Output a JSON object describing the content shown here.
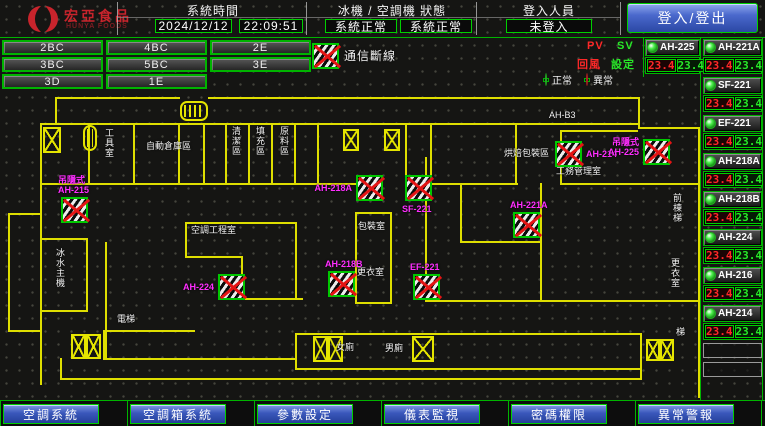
{
  "colors": {
    "accent_green": "#00c800",
    "alarm_red": "#e41414",
    "magenta": "#ff2eff",
    "wall_yellow": "#dede00",
    "button_blue": "#3a57bb"
  },
  "header": {
    "logo": {
      "brand": "宏亞食品",
      "brand_sub": "HUNYA FOODS"
    },
    "system_time": {
      "label": "系統時間",
      "date": "2024/12/12",
      "time": "22:09:51"
    },
    "machine_status": {
      "label": "冰機 / 空調機 狀態",
      "chiller": "系統正常",
      "ahu": "系統正常"
    },
    "login": {
      "label": "登入人員",
      "user": "未登入",
      "button_label": "登入/登出"
    }
  },
  "floor_nav": {
    "buttons": [
      "2BC",
      "4BC",
      "2E",
      "3BC",
      "5BC",
      "3E",
      "3D",
      "1E"
    ]
  },
  "legend": {
    "comm_fail": "通信斷線",
    "normal": "正常",
    "abnormal": "異常",
    "pv": "PV",
    "sv": "SV",
    "pv_col": "回風",
    "sv_col": "設定"
  },
  "units": {
    "left_column": [
      {
        "name": "AH-225",
        "pv": "23.4",
        "sv": "23.4",
        "status": "normal"
      }
    ],
    "right_column": [
      {
        "name": "AH-221A",
        "pv": "23.4",
        "sv": "23.4",
        "status": "normal"
      },
      {
        "name": "SF-221",
        "pv": "23.4",
        "sv": "23.4",
        "status": "normal"
      },
      {
        "name": "EF-221",
        "pv": "23.4",
        "sv": "23.4",
        "status": "normal"
      },
      {
        "name": "AH-218A",
        "pv": "23.4",
        "sv": "23.4",
        "status": "normal"
      },
      {
        "name": "AH-218B",
        "pv": "23.4",
        "sv": "23.4",
        "status": "normal"
      },
      {
        "name": "AH-224",
        "pv": "23.4",
        "sv": "23.4",
        "status": "normal"
      },
      {
        "name": "AH-216",
        "pv": "23.4",
        "sv": "23.4",
        "status": "normal"
      },
      {
        "name": "AH-214",
        "pv": "23.4",
        "sv": "23.4",
        "status": "normal"
      }
    ],
    "empty_slots": 2
  },
  "floor_plan": {
    "room_labels": [
      {
        "text": "工具室",
        "x": 104,
        "y": 128,
        "vertical": true
      },
      {
        "text": "自動倉庫區",
        "x": 146,
        "y": 141
      },
      {
        "text": "清潔區",
        "x": 231,
        "y": 126,
        "vertical": true
      },
      {
        "text": "填充區",
        "x": 255,
        "y": 126,
        "vertical": true
      },
      {
        "text": "原料區",
        "x": 279,
        "y": 126,
        "vertical": true
      },
      {
        "text": "AH-B3",
        "x": 549,
        "y": 110
      },
      {
        "text": "烘焙包裝區",
        "x": 504,
        "y": 148
      },
      {
        "text": "工務管理室",
        "x": 556,
        "y": 166
      },
      {
        "text": "空調工程室",
        "x": 191,
        "y": 225
      },
      {
        "text": "包裝室",
        "x": 358,
        "y": 221
      },
      {
        "text": "更衣室",
        "x": 357,
        "y": 267
      },
      {
        "text": "女廁",
        "x": 336,
        "y": 342
      },
      {
        "text": "男廁",
        "x": 385,
        "y": 343
      },
      {
        "text": "冰水主機",
        "x": 55,
        "y": 248,
        "vertical": true
      },
      {
        "text": "電梯",
        "x": 117,
        "y": 314
      },
      {
        "text": "前棟梯",
        "x": 672,
        "y": 193,
        "vertical": true
      },
      {
        "text": "更衣室",
        "x": 670,
        "y": 258,
        "vertical": true
      },
      {
        "text": "梯",
        "x": 676,
        "y": 327
      }
    ],
    "device_markers": [
      {
        "name": "AH-215",
        "lines": [
          "吊隱式",
          "AH-215"
        ],
        "x": 61,
        "y": 197,
        "label_pos": "above"
      },
      {
        "name": "AH-224",
        "lines": [
          "AH-224"
        ],
        "x": 218,
        "y": 274,
        "label_pos": "left"
      },
      {
        "name": "AH-218B",
        "lines": [
          "AH-218B"
        ],
        "x": 328,
        "y": 271,
        "label_pos": "above"
      },
      {
        "name": "EF-221",
        "lines": [
          "EF-221"
        ],
        "x": 413,
        "y": 274,
        "label_pos": "above"
      },
      {
        "name": "AH-218A",
        "lines": [
          "AH-218A"
        ],
        "x": 356,
        "y": 175,
        "label_pos": "left"
      },
      {
        "name": "SF-221",
        "lines": [
          "SF-221"
        ],
        "x": 405,
        "y": 175,
        "label_pos": "below"
      },
      {
        "name": "AH-221A",
        "lines": [
          "AH-221A"
        ],
        "x": 513,
        "y": 212,
        "label_pos": "above"
      },
      {
        "name": "AH-214",
        "lines": [
          "AH-214"
        ],
        "x": 555,
        "y": 141,
        "label_pos": "right"
      },
      {
        "name": "AH-225",
        "lines": [
          "吊隱式",
          "AH-225"
        ],
        "x": 643,
        "y": 139,
        "label_pos": "left"
      }
    ],
    "stairs": [
      {
        "type": "x",
        "x": 43,
        "y": 127,
        "w": 18,
        "h": 26,
        "cells": 1
      },
      {
        "type": "elevator",
        "x": 180,
        "y": 101,
        "w": 28,
        "h": 20
      },
      {
        "type": "elevator",
        "x": 83,
        "y": 125,
        "w": 14,
        "h": 26
      },
      {
        "type": "x",
        "x": 343,
        "y": 129,
        "w": 16,
        "h": 22,
        "cells": 1
      },
      {
        "type": "x",
        "x": 384,
        "y": 129,
        "w": 16,
        "h": 22,
        "cells": 1
      },
      {
        "type": "x",
        "x": 313,
        "y": 336,
        "w": 30,
        "h": 26,
        "cells": 2
      },
      {
        "type": "x",
        "x": 412,
        "y": 336,
        "w": 22,
        "h": 26,
        "cells": 1
      },
      {
        "type": "x",
        "x": 71,
        "y": 334,
        "w": 30,
        "h": 25,
        "cells": 2
      },
      {
        "type": "x",
        "x": 646,
        "y": 339,
        "w": 28,
        "h": 22,
        "cells": 2
      }
    ],
    "walls": [
      [
        55,
        97,
        125,
        2
      ],
      [
        208,
        97,
        432,
        2
      ],
      [
        55,
        97,
        2,
        28
      ],
      [
        638,
        97,
        2,
        32
      ],
      [
        40,
        123,
        600,
        2
      ],
      [
        40,
        123,
        2,
        262
      ],
      [
        88,
        123,
        2,
        62
      ],
      [
        133,
        123,
        2,
        62
      ],
      [
        178,
        123,
        2,
        62
      ],
      [
        203,
        123,
        2,
        62
      ],
      [
        225,
        123,
        2,
        62
      ],
      [
        248,
        123,
        2,
        62
      ],
      [
        271,
        123,
        2,
        62
      ],
      [
        294,
        123,
        2,
        62
      ],
      [
        317,
        123,
        2,
        62
      ],
      [
        405,
        123,
        2,
        62
      ],
      [
        430,
        123,
        2,
        62
      ],
      [
        515,
        123,
        2,
        62
      ],
      [
        40,
        183,
        320,
        2
      ],
      [
        430,
        183,
        88,
        2
      ],
      [
        560,
        183,
        140,
        2
      ],
      [
        560,
        130,
        2,
        55
      ],
      [
        560,
        130,
        78,
        2
      ],
      [
        638,
        127,
        62,
        2
      ],
      [
        698,
        127,
        2,
        271
      ],
      [
        8,
        213,
        2,
        119
      ],
      [
        8,
        213,
        34,
        2
      ],
      [
        8,
        330,
        34,
        2
      ],
      [
        42,
        238,
        46,
        2
      ],
      [
        86,
        238,
        2,
        74
      ],
      [
        42,
        310,
        46,
        2
      ],
      [
        105,
        242,
        2,
        118
      ],
      [
        185,
        222,
        112,
        2
      ],
      [
        185,
        222,
        2,
        36
      ],
      [
        185,
        256,
        58,
        2
      ],
      [
        241,
        256,
        2,
        44
      ],
      [
        241,
        298,
        62,
        2
      ],
      [
        295,
        222,
        2,
        78
      ],
      [
        355,
        212,
        37,
        2
      ],
      [
        355,
        212,
        2,
        92
      ],
      [
        390,
        212,
        2,
        92
      ],
      [
        355,
        302,
        37,
        2
      ],
      [
        425,
        157,
        2,
        145
      ],
      [
        425,
        300,
        273,
        2
      ],
      [
        460,
        183,
        2,
        60
      ],
      [
        460,
        241,
        82,
        2
      ],
      [
        540,
        183,
        2,
        119
      ],
      [
        103,
        330,
        92,
        2
      ],
      [
        103,
        330,
        2,
        30
      ],
      [
        103,
        358,
        192,
        2
      ],
      [
        295,
        333,
        347,
        2
      ],
      [
        295,
        368,
        347,
        2
      ],
      [
        295,
        333,
        2,
        37
      ],
      [
        640,
        333,
        2,
        37
      ],
      [
        60,
        378,
        580,
        2
      ],
      [
        640,
        368,
        2,
        12
      ],
      [
        60,
        358,
        2,
        22
      ]
    ]
  },
  "footer": {
    "buttons": [
      "空調系統",
      "空調箱系統",
      "參數設定",
      "儀表監視",
      "密碼權限",
      "異常警報"
    ]
  }
}
